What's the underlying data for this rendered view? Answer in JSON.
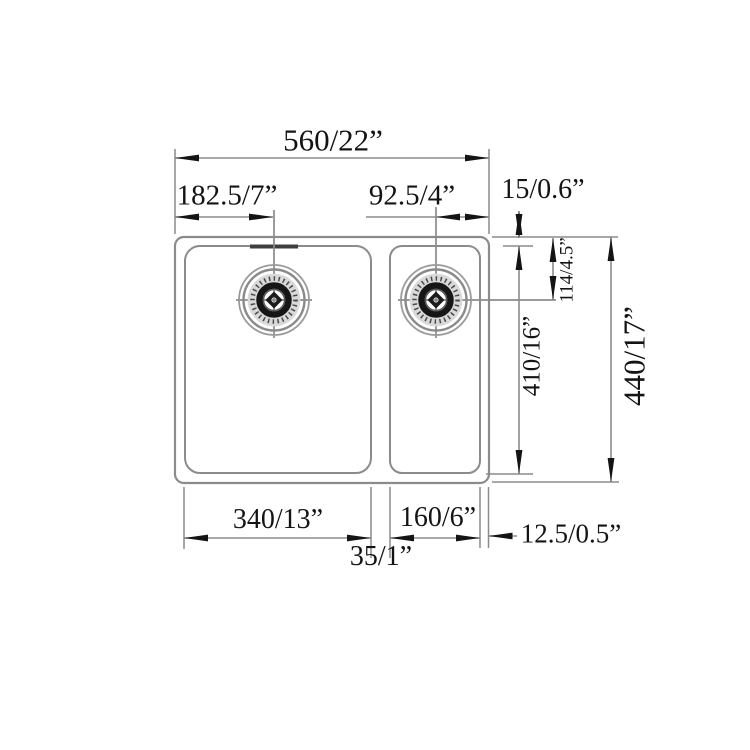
{
  "colors": {
    "paper": "#ffffff",
    "line": "#8b8b8b",
    "ink": "#141414"
  },
  "drawing_type": "double-bowl-sink-dimension-diagram",
  "dims": {
    "overall_width": "560/22”",
    "left_drain_offset": "182.5/7”",
    "right_drain_offset": "92.5/4”",
    "rim_top": "15/0.6”",
    "drain_center_depth": "114/4.5”",
    "bowl_depth": "410/16”",
    "overall_depth": "440/17”",
    "left_bowl_width": "340/13”",
    "right_bowl_width": "160/6”",
    "divider_width": "35/1”",
    "rim_right": "12.5/0.5”"
  }
}
